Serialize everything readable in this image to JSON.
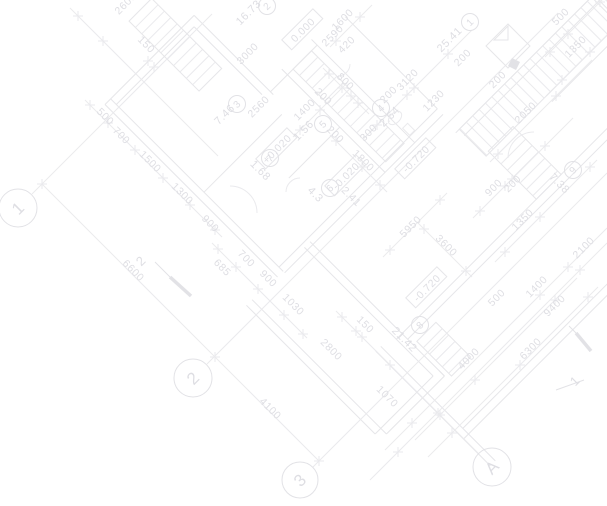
{
  "document": {
    "type": "architectural-floor-plan",
    "rotation_deg": 45
  },
  "colors": {
    "background": "#ffffff",
    "line": "#eaeaed",
    "wall": "#e6e6e9",
    "strong": "#e2e2e6",
    "text": "#dedee3"
  },
  "grid_bubbles": [
    {
      "label": "1",
      "x": 18,
      "y": 208,
      "r": 19
    },
    {
      "label": "2",
      "x": 193,
      "y": 378,
      "r": 19
    },
    {
      "label": "3",
      "x": 300,
      "y": 480,
      "r": 18
    },
    {
      "label": "A",
      "x": 492,
      "y": 467,
      "r": 19
    }
  ],
  "room_tags": [
    {
      "number": "1",
      "area": "25.41",
      "cx": 470,
      "cy": 22,
      "ax": 452,
      "ay": 42,
      "arot": -45
    },
    {
      "number": "2",
      "area": "16.73",
      "cx": 267,
      "cy": 6,
      "ax": 251,
      "ay": 15,
      "arot": -45
    },
    {
      "number": "3",
      "area": "7.46",
      "cx": 237,
      "cy": 104,
      "ax": 227,
      "ay": 117,
      "arot": -45
    },
    {
      "number": "4",
      "area": "2.64",
      "cx": 381,
      "cy": 108,
      "ax": 392,
      "ay": 119,
      "arot": -45
    },
    {
      "number": "5",
      "area": "1.56",
      "cx": 323,
      "cy": 124,
      "ax": 306,
      "ay": 133,
      "arot": -45
    },
    {
      "number": "6",
      "area": "4.3",
      "cx": 330,
      "cy": 188,
      "ax": 313,
      "ay": 197,
      "arot": 45
    },
    {
      "number": "7",
      "area": "1.68",
      "cx": 270,
      "cy": 158,
      "ax": 258,
      "ay": 173,
      "arot": 45
    },
    {
      "number": "8",
      "area": "21.42",
      "cx": 420,
      "cy": 325,
      "ax": 402,
      "ay": 342,
      "arot": 45
    },
    {
      "number": "9",
      "area": "7.38",
      "cx": 573,
      "cy": 170,
      "ax": 557,
      "ay": 186,
      "arot": 45
    }
  ],
  "elevation_marks": [
    {
      "text": "0.000",
      "x": 303,
      "y": 30,
      "rot": -45
    },
    {
      "text": "+0.020",
      "x": 277,
      "y": 149,
      "rot": -45
    },
    {
      "text": "-0.020",
      "x": 346,
      "y": 176,
      "rot": -45
    },
    {
      "text": "-0.720",
      "x": 416,
      "y": 159,
      "rot": -45
    },
    {
      "text": "-0.720",
      "x": 427,
      "y": 288,
      "rot": -45
    }
  ],
  "section_marks": [
    {
      "label": "2",
      "x": 144,
      "y": 264
    },
    {
      "label": "1",
      "x": 578,
      "y": 384
    }
  ],
  "dimensions": [
    {
      "text": "150",
      "x": 144,
      "y": 47,
      "rot": 45
    },
    {
      "text": "2600",
      "x": 128,
      "y": 6,
      "rot": -45
    },
    {
      "text": "500",
      "x": 103,
      "y": 119,
      "rot": 45
    },
    {
      "text": "700",
      "x": 119,
      "y": 138,
      "rot": 45
    },
    {
      "text": "1500",
      "x": 148,
      "y": 164,
      "rot": 45
    },
    {
      "text": "1300",
      "x": 180,
      "y": 196,
      "rot": 45
    },
    {
      "text": "900",
      "x": 208,
      "y": 226,
      "rot": 45
    },
    {
      "text": "6600",
      "x": 131,
      "y": 273,
      "rot": 45
    },
    {
      "text": "4100",
      "x": 268,
      "y": 411,
      "rot": 45
    },
    {
      "text": "685",
      "x": 220,
      "y": 270,
      "rot": 45
    },
    {
      "text": "700",
      "x": 244,
      "y": 261,
      "rot": 45
    },
    {
      "text": "900",
      "x": 266,
      "y": 281,
      "rot": 45
    },
    {
      "text": "1030",
      "x": 291,
      "y": 307,
      "rot": 45
    },
    {
      "text": "2800",
      "x": 329,
      "y": 352,
      "rot": 45
    },
    {
      "text": "150",
      "x": 363,
      "y": 327,
      "rot": 45
    },
    {
      "text": "1070",
      "x": 385,
      "y": 399,
      "rot": 45
    },
    {
      "text": "3600",
      "x": 444,
      "y": 248,
      "rot": 45
    },
    {
      "text": "800",
      "x": 343,
      "y": 84,
      "rot": 45
    },
    {
      "text": "200",
      "x": 321,
      "y": 99,
      "rot": 45
    },
    {
      "text": "1800",
      "x": 361,
      "y": 163,
      "rot": 45
    },
    {
      "text": "200",
      "x": 333,
      "y": 137,
      "rot": 45
    },
    {
      "text": "2.41",
      "x": 349,
      "y": 199,
      "rot": 45
    },
    {
      "text": "3000",
      "x": 250,
      "y": 56,
      "rot": -45
    },
    {
      "text": "2560",
      "x": 261,
      "y": 109,
      "rot": -45
    },
    {
      "text": "1600",
      "x": 345,
      "y": 22,
      "rot": -45
    },
    {
      "text": "2590",
      "x": 335,
      "y": 38,
      "rot": -45
    },
    {
      "text": "420",
      "x": 349,
      "y": 47,
      "rot": -45
    },
    {
      "text": "1400",
      "x": 307,
      "y": 112,
      "rot": -45
    },
    {
      "text": "3120",
      "x": 410,
      "y": 82,
      "rot": -45
    },
    {
      "text": "200",
      "x": 391,
      "y": 97,
      "rot": -45
    },
    {
      "text": "1230",
      "x": 436,
      "y": 103,
      "rot": -45
    },
    {
      "text": "300",
      "x": 371,
      "y": 135,
      "rot": -45
    },
    {
      "text": "5950",
      "x": 413,
      "y": 229,
      "rot": -45
    },
    {
      "text": "200",
      "x": 465,
      "y": 60,
      "rot": -45
    },
    {
      "text": "200",
      "x": 500,
      "y": 82,
      "rot": -45
    },
    {
      "text": "2050",
      "x": 528,
      "y": 115,
      "rot": -45
    },
    {
      "text": "1350",
      "x": 578,
      "y": 49,
      "rot": -45
    },
    {
      "text": "500",
      "x": 563,
      "y": 19,
      "rot": -45
    },
    {
      "text": "900",
      "x": 496,
      "y": 190,
      "rot": -45
    },
    {
      "text": "200",
      "x": 515,
      "y": 186,
      "rot": -45
    },
    {
      "text": "1350",
      "x": 525,
      "y": 222,
      "rot": -45
    },
    {
      "text": "2100",
      "x": 586,
      "y": 250,
      "rot": -45
    },
    {
      "text": "500",
      "x": 499,
      "y": 300,
      "rot": -45
    },
    {
      "text": "4000",
      "x": 471,
      "y": 361,
      "rot": -45
    },
    {
      "text": "6300",
      "x": 533,
      "y": 351,
      "rot": -45
    },
    {
      "text": "1400",
      "x": 539,
      "y": 289,
      "rot": -45
    },
    {
      "text": "9400",
      "x": 557,
      "y": 308,
      "rot": -45
    }
  ]
}
